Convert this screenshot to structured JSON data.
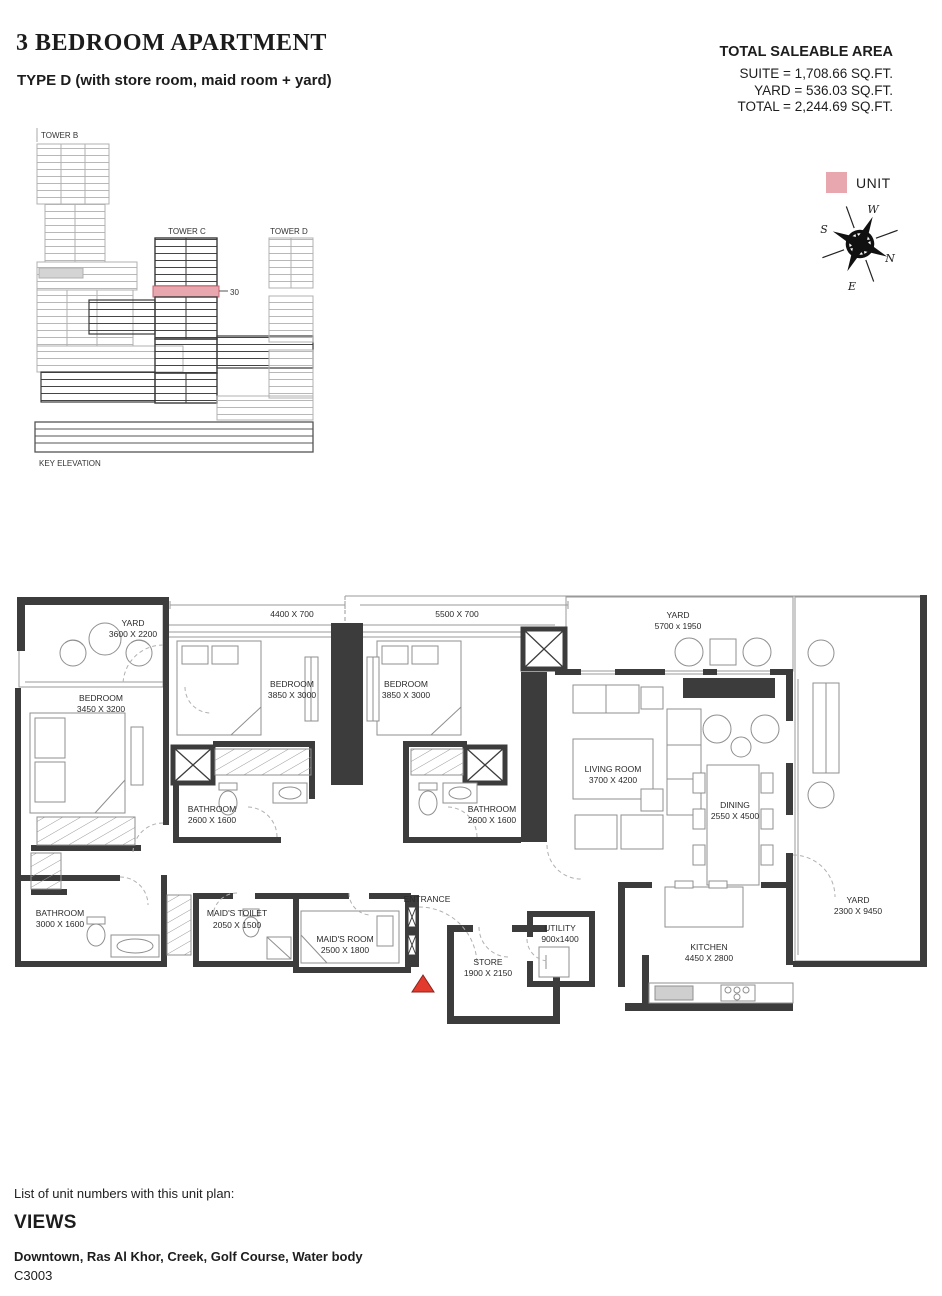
{
  "header": {
    "title": "3 BEDROOM APARTMENT",
    "subtitle": "TYPE D (with store room, maid room + yard)"
  },
  "area_summary": {
    "heading": "TOTAL SALEABLE AREA",
    "suite": "SUITE = 1,708.66 SQ.FT.",
    "yard": "YARD = 536.03 SQ.FT.",
    "total": "TOTAL = 2,244.69 SQ.FT."
  },
  "key_elevation": {
    "tower_b": "TOWER B",
    "tower_c": "TOWER C",
    "tower_d": "TOWER D",
    "floor_marker": "30",
    "caption": "KEY ELEVATION",
    "highlight_color": "#e8a6ae"
  },
  "legend": {
    "unit_label": "UNIT",
    "unit_color": "#e8a6ae"
  },
  "compass": {
    "west": "W",
    "south": "S",
    "north": "N",
    "east": "E",
    "north_color": "#c0392b"
  },
  "floor_plan": {
    "entrance_label": "ENTRANCE",
    "entrance_marker_color": "#e23b2e",
    "wall_color": "#3c3c3c",
    "dim_labels": [
      "4400 X 700",
      "5500 X 700"
    ],
    "rooms": [
      {
        "name": "YARD",
        "dims": "3600 X 2200"
      },
      {
        "name": "BEDROOM",
        "dims": "3450 X 3200"
      },
      {
        "name": "BEDROOM",
        "dims": "3850 X 3000"
      },
      {
        "name": "BEDROOM",
        "dims": "3850 X 3000"
      },
      {
        "name": "BATHROOM",
        "dims": "2600 X 1600"
      },
      {
        "name": "BATHROOM",
        "dims": "2600 X 1600"
      },
      {
        "name": "LIVING ROOM",
        "dims": "3700 X 4200"
      },
      {
        "name": "DINING",
        "dims": "2550 X 4500"
      },
      {
        "name": "YARD",
        "dims": "5700 x 1950"
      },
      {
        "name": "YARD",
        "dims": "2300 X 9450"
      },
      {
        "name": "BATHROOM",
        "dims": "3000 X 1600"
      },
      {
        "name": "MAID'S TOILET",
        "dims": "2050 X 1500"
      },
      {
        "name": "MAID'S ROOM",
        "dims": "2500 X 1800"
      },
      {
        "name": "STORE",
        "dims": "1900 X 2150"
      },
      {
        "name": "UTILITY",
        "dims": "900x1400"
      },
      {
        "name": "KITCHEN",
        "dims": "4450 X 2800"
      }
    ]
  },
  "footer": {
    "list_caption": "List of unit numbers with this unit plan:",
    "views_heading": "VIEWS",
    "views_list": "Downtown, Ras Al Khor, Creek, Golf Course, Water body",
    "unit_number": "C3003"
  }
}
